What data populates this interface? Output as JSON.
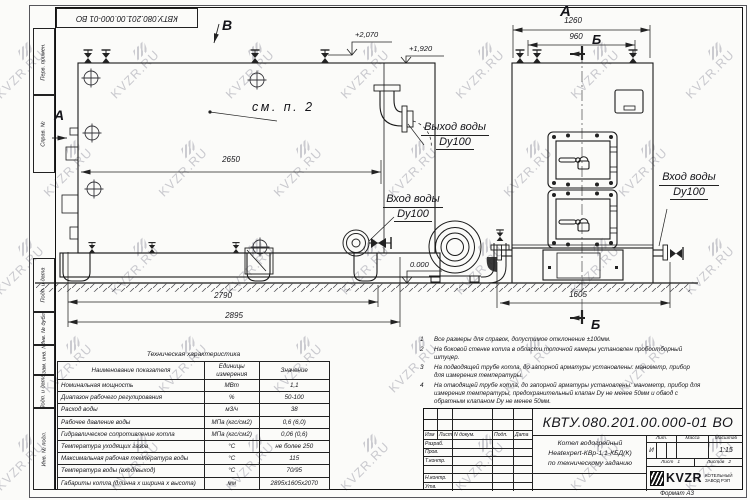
{
  "doc_number": "КВТУ.080.201.00.000-01 ВО",
  "watermark": {
    "text": "KVZR.RU"
  },
  "side_fields": [
    "Перв. примен.",
    "Справ. №",
    "Подп. и дата",
    "Инв. № дубл.",
    "Взам. инв. №",
    "Подп. и дата",
    "Инв. № подл."
  ],
  "views": {
    "view_b": "В",
    "view_a_side": "А",
    "view_a_front": "А",
    "section_b_top": "Б",
    "section_b_bottom": "Б"
  },
  "labels": {
    "see_note": "см. п. 2",
    "outlet_line1": "Выход воды",
    "outlet_line2": "Dy100",
    "inlet_line1": "Вход воды",
    "inlet_line2": "Dy100"
  },
  "dims": {
    "d2650": "2650",
    "d2790": "2790",
    "d2895": "2895",
    "d1260": "1260",
    "d960": "960",
    "d1605": "1605",
    "lvl_top": "+2,070",
    "lvl_mid": "+1,920",
    "lvl_zero": "0.000"
  },
  "spec_table": {
    "title": "Техническая характеристика",
    "headers": [
      "Наименование показателя",
      "Единицы измерения",
      "Значение"
    ],
    "rows": [
      [
        "Номинальная мощность",
        "МВт",
        "1,1"
      ],
      [
        "Диапазон рабочего регулирования",
        "%",
        "50-100"
      ],
      [
        "Расход воды",
        "м3/ч",
        "38"
      ],
      [
        "Рабочее давление воды",
        "МПа (кгс/см2)",
        "0,6 (6,0)"
      ],
      [
        "Гидравлическое сопротивление котла",
        "МПа (кгс/см2)",
        "0,06 (0,6)"
      ],
      [
        "Температура уходящих газов",
        "°С",
        "не более 250"
      ],
      [
        "Максимальная рабочая температура воды",
        "°С",
        "115"
      ],
      [
        "Температура воды (вход/выход)",
        "°С",
        "70/95"
      ],
      [
        "Габариты котла (длинна х ширина х высота)",
        "мм",
        "2895х1605х2070"
      ]
    ]
  },
  "notes": [
    [
      "1",
      "Все размеры для справок, допустимое отклонение ±100мм."
    ],
    [
      "2",
      "На боковой стенке котла в области топочной камеры установлен пробоотборный штуцер."
    ],
    [
      "3",
      "На подводящей трубе котла, до запорной арматуры установлены: манометр, прибор для измерения температуры."
    ],
    [
      "4",
      "На отводящей трубе котла, до запорной арматуры установлены: манометр, прибор для измерения температуры, предохранительный клапан Dу не менее 50мм и обвод с обратным клапаном Dу не менее 50мм."
    ]
  ],
  "stamp": {
    "cols": {
      "izm": "Изм",
      "list": "Лист",
      "ndoc": "N докум.",
      "podp": "Подп.",
      "data": "Дата"
    },
    "roles": {
      "r1": "Разраб.",
      "r2": "Пров.",
      "r3": "Т.контр.",
      "r4": "Н.контр.",
      "r5": "Утв."
    },
    "title1": "Котел водогрейный",
    "title2": "Heatexpert-КВр-1,1-КБД(К)",
    "title3": "по техническому заданию",
    "lit_label": "Лит.",
    "mass_label": "Масса",
    "scale_label": "Масштаб",
    "lit": "И",
    "scale": "1:15",
    "sheet_label": "Лист",
    "sheet": "1",
    "sheets_label": "Листов",
    "sheets": "2",
    "brand": "KVZR",
    "brand_line1": "КОТЕЛЬНЫЙ",
    "brand_line2": "ЗАВОД РЭП",
    "format": "Формат  А3"
  }
}
